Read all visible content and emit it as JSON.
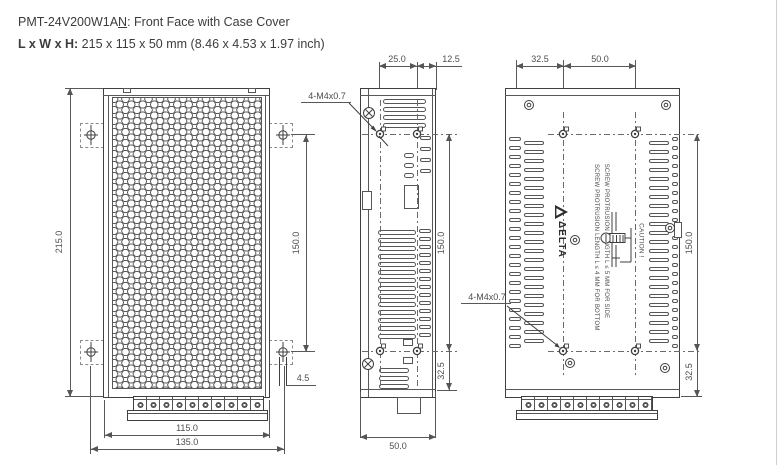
{
  "header": {
    "model_prefix": "PMT-24V200W1A",
    "model_underlined": "N",
    "title_rest": ": Front Face with Case Cover",
    "size_label": "L x W x H:",
    "size_value": " 215 x 115 x 50 mm (8.46 x 4.53 x 1.97 inch)"
  },
  "front_view": {
    "dim_height": "215.0",
    "dim_hole_span": "150.0",
    "dim_body_width": "115.0",
    "dim_tab_span": "135.0",
    "dim_hole_width": "4.5"
  },
  "side_view": {
    "screw_spec": "4-M4x0.7",
    "dim_hole_pitch": "25.0",
    "dim_hole_edge": "12.5",
    "dim_hole_span": "150.0",
    "dim_hole_bottom": "32.5",
    "dim_depth": "50.0"
  },
  "back_view": {
    "screw_spec": "4-M4x0.7",
    "dim_hole_edge": "32.5",
    "dim_hole_pitch": "50.0",
    "dim_hole_span": "150.0",
    "dim_hole_bottom": "32.5",
    "brand": "ΔELTA",
    "caution_bottom": "SCREW PROTRUSION LENGTH  L ≤ 4 MM FOR BOTTOM",
    "caution_side": "SCREW PROTRUSION LENGTH  L ≤ 5 MM FOR SIDE",
    "caution_title": "CAUTION !"
  }
}
